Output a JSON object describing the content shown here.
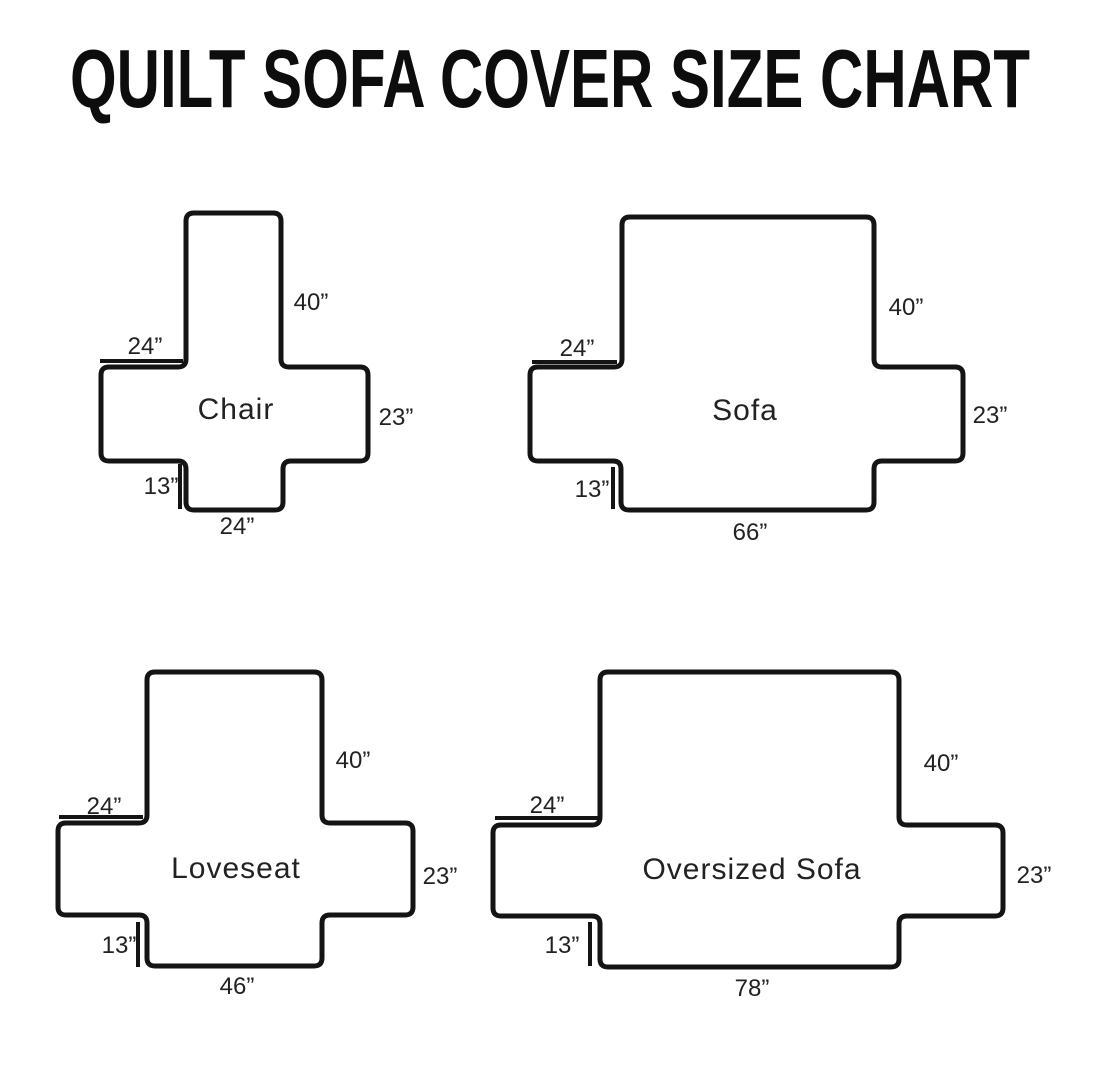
{
  "title": "QUILT SOFA COVER SIZE CHART",
  "colors": {
    "ink": "#141414",
    "text": "#222222",
    "background": "#ffffff"
  },
  "diagrams": [
    {
      "name": "Chair",
      "dimensions": {
        "back_height": "40”",
        "arm_length": "24”",
        "side_height": "23”",
        "front_height": "13”",
        "seat_width": "24”"
      }
    },
    {
      "name": "Sofa",
      "dimensions": {
        "back_height": "40”",
        "arm_length": "24”",
        "side_height": "23”",
        "front_height": "13”",
        "seat_width": "66”"
      }
    },
    {
      "name": "Loveseat",
      "dimensions": {
        "back_height": "40”",
        "arm_length": "24”",
        "side_height": "23”",
        "front_height": "13”",
        "seat_width": "46”"
      }
    },
    {
      "name": "Oversized Sofa",
      "dimensions": {
        "back_height": "40”",
        "arm_length": "24”",
        "side_height": "23”",
        "front_height": "13”",
        "seat_width": "78”"
      }
    }
  ]
}
